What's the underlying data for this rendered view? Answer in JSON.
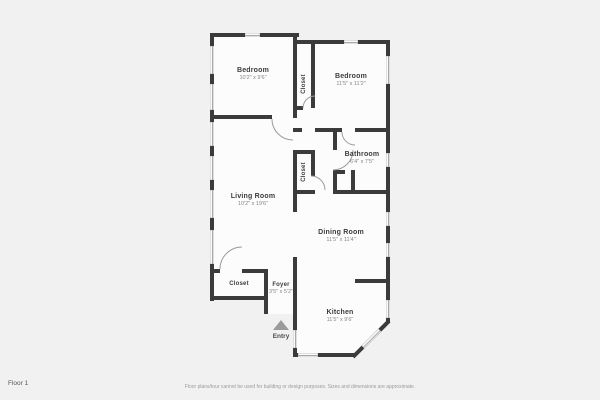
{
  "page": {
    "floor_label": "Floor 1",
    "disclaimer": "Floor plans/tour cannot be used for building or design purposes. Sizes and dimensions are approximate."
  },
  "rooms": {
    "bedroom_left": {
      "name": "Bedroom",
      "dims": "10'2\" x 9'6\""
    },
    "closet_top": {
      "name": "Closet"
    },
    "bedroom_right": {
      "name": "Bedroom",
      "dims": "11'5\" x 11'2\""
    },
    "bathroom": {
      "name": "Bathroom",
      "dims": "6'4\" x 7'5\""
    },
    "living_room": {
      "name": "Living Room",
      "dims": "10'2\" x 19'6\""
    },
    "closet_middle": {
      "name": "Closet"
    },
    "dining_room": {
      "name": "Dining Room",
      "dims": "11'5\" x 11'4\""
    },
    "closet_entry": {
      "name": "Closet"
    },
    "foyer": {
      "name": "Foyer",
      "dims": "3'5\" x 5'2\""
    },
    "kitchen": {
      "name": "Kitchen",
      "dims": "11'5\" x 9'6\""
    },
    "entry": {
      "name": "Entry"
    }
  },
  "colors": {
    "background": "#f1f1f1",
    "floor": "#fcfcfc",
    "wall": "#3b3b3b",
    "window_line": "#a8a8a8",
    "room_name": "#3c3c3c",
    "room_dims": "#858585",
    "entry_arrow": "#9b9b9b"
  }
}
